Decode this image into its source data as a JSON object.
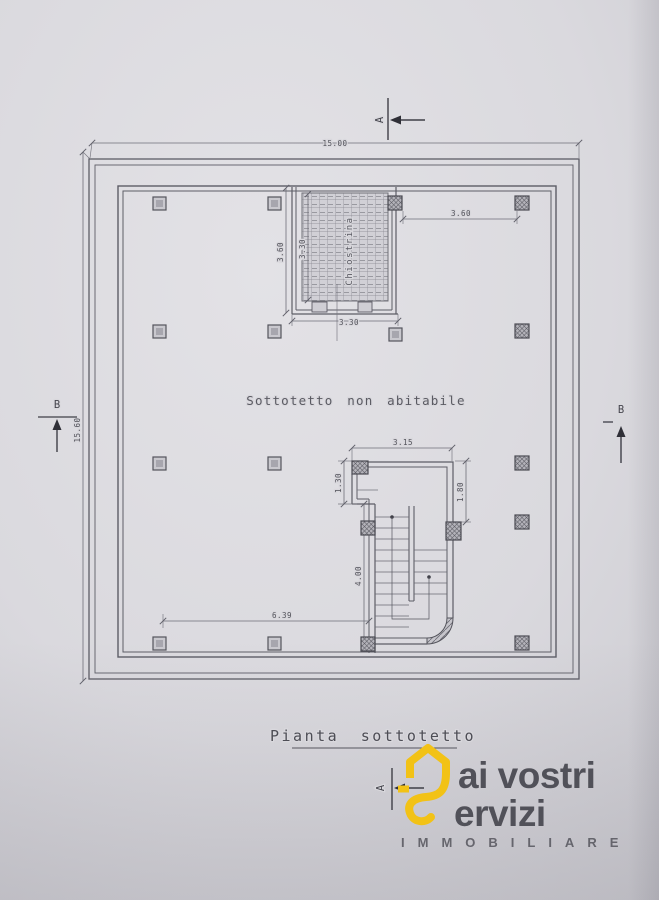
{
  "drawing": {
    "room_label": "Sottotetto non abitabile",
    "courtyard_label": "Chiostrina",
    "caption": "Pianta sottotetto",
    "dimensions": {
      "overall_width": "15.00",
      "overall_height": "15.60",
      "courtyard_ext_height": "3.60",
      "courtyard_int_height": "3.30",
      "courtyard_width": "3.30",
      "right_span": "3.60",
      "stair_width": "3.15",
      "stair_notch_height": "1.30",
      "stair_right_height": "1.80",
      "stair_length": "4.00",
      "bottom_span": "6.39"
    },
    "section_markers": {
      "a": "A",
      "b": "B"
    }
  },
  "logo": {
    "line1": "ai vostri",
    "line2": "ervizi",
    "tagline": "IMMOBILIARE",
    "accent_color": "#f2c216",
    "text_color": "#333e51"
  },
  "colors": {
    "paper": "#d9d8dd",
    "ink": "#5d5d66"
  }
}
